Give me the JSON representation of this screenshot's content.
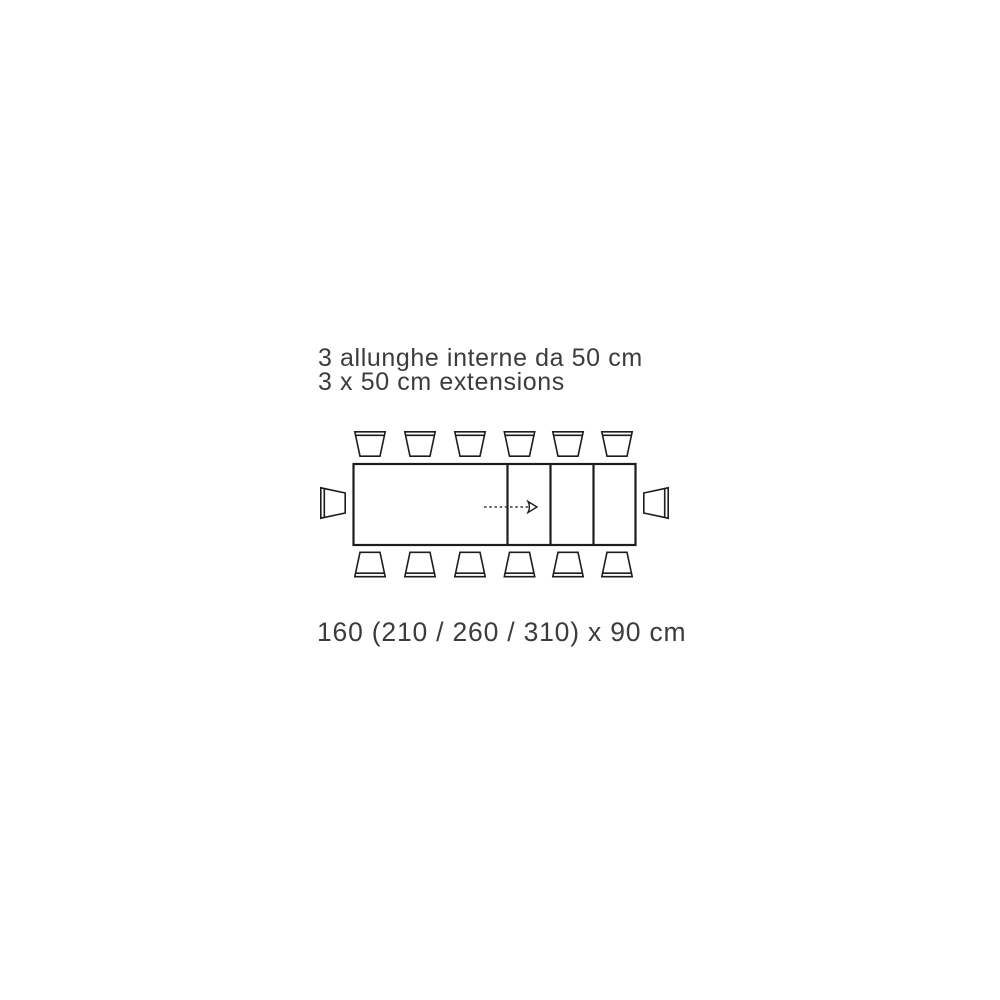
{
  "page": {
    "background_color": "#ffffff",
    "line_color": "#1d1d1b",
    "text_color": "#3c3c3c"
  },
  "captions": {
    "extensions_italian": "3 allunghe interne da 50 cm",
    "extensions_english": "3 x 50 cm extensions",
    "dimensions": "160 (210 / 260 / 310) x 90 cm"
  },
  "diagram": {
    "type": "extendable-dining-table-top-view",
    "extension_leaves": 3,
    "extension_size_cm": 50,
    "table_length_closed_cm": 160,
    "table_lengths_extended_cm": [
      210,
      260,
      310
    ],
    "table_depth_cm": 90,
    "seat_count_top": 6,
    "seat_count_bottom": 6,
    "seat_count_left": 1,
    "seat_count_right": 1,
    "seat_count_total": 14
  }
}
